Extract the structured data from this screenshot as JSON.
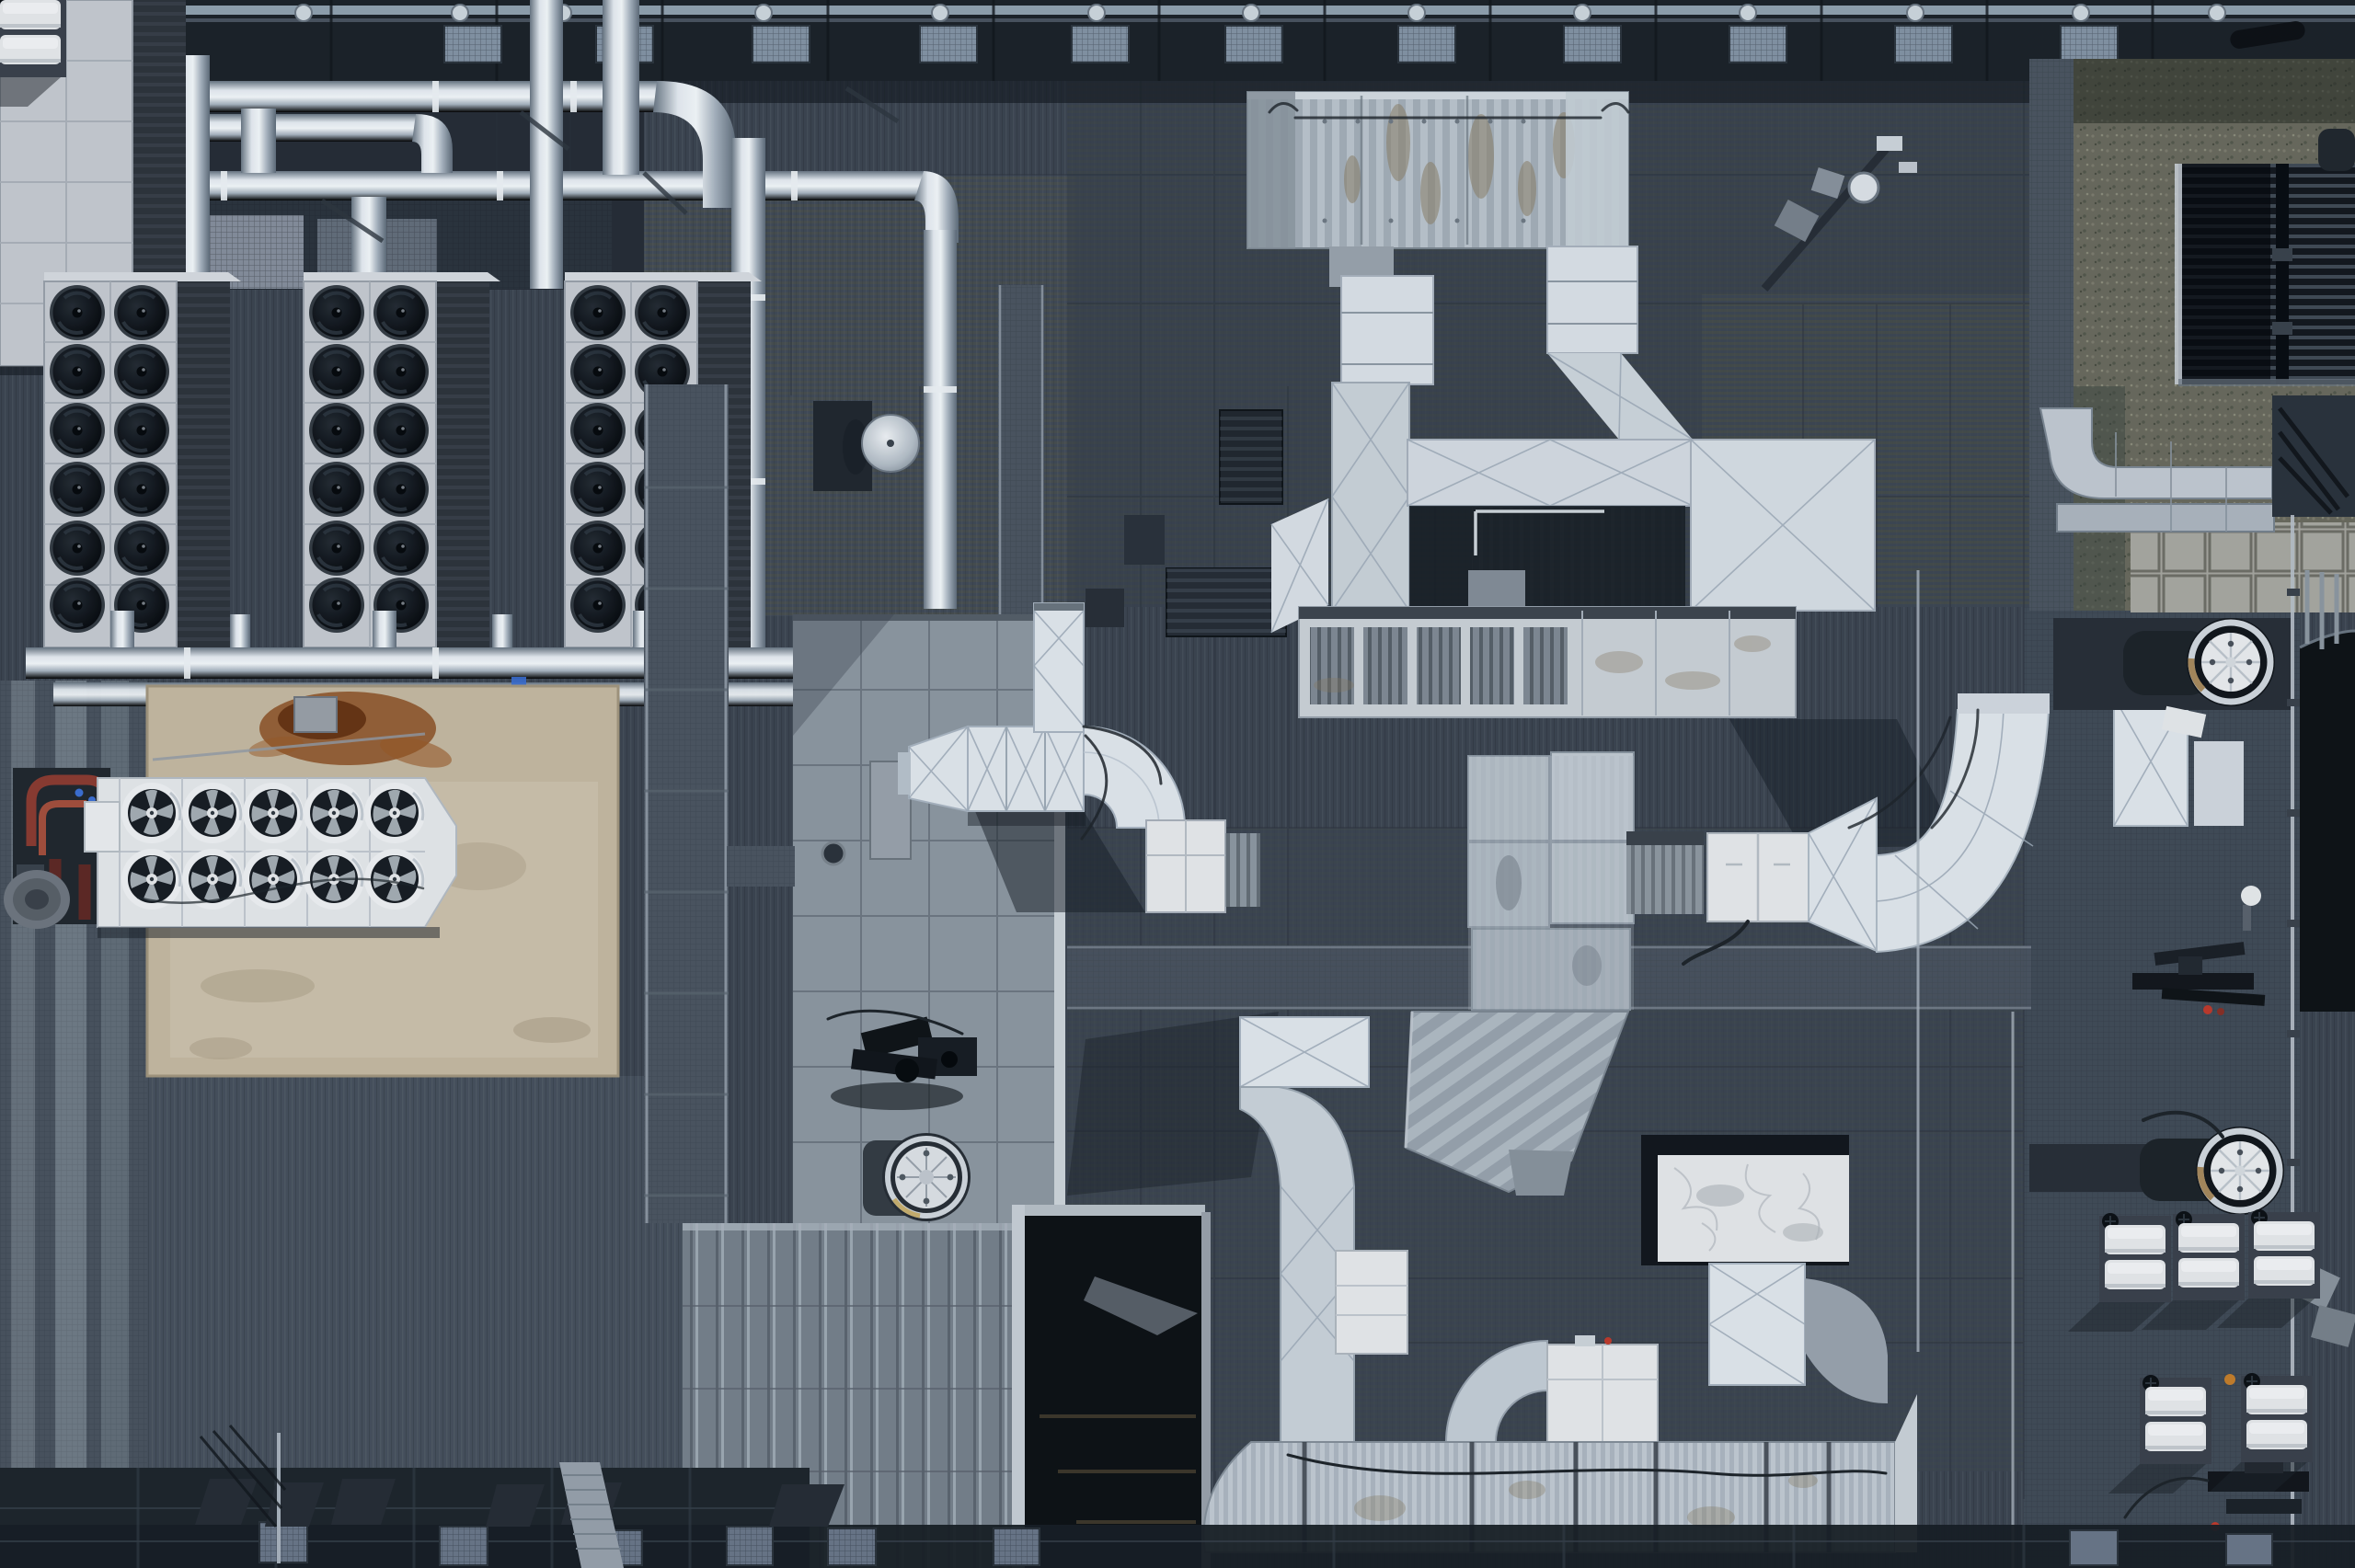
{
  "scene": {
    "type": "aerial-rooftop-photograph",
    "view": "top-down drone view, daytime, low sun casting shadows toward lower-left",
    "subject": "large commercial building rooftop crowded with HVAC equipment, silver refrigerant piping, white insulated ductwork, walkway gratings, gravel edge strip and maintenance machinery"
  },
  "colors": {
    "roof-base": "#3b4450",
    "roof-shadow": "#252c35",
    "strip-dark": "#1b2127",
    "mesh-light": "#8494a5",
    "frame-white": "#c8ccd2",
    "frame-light": "#dde0e4",
    "slat-dark": "#3e454e",
    "fan-dark": "#0e1217",
    "pad-beige": "#c7baa2",
    "rust": "#8a4a1c",
    "skid-dark": "#20262d",
    "pipe-red": "#8c3a30",
    "duct-white": "#e3e9ef",
    "duct-shade": "#b9c4d0",
    "duct-crease": "#9fabb8",
    "corr-gray": "#b2bcc5",
    "stain-brown": "#8a7c60",
    "panel-gray": "#8e98a2",
    "panel-line": "#67717b",
    "walk-gray": "#4b5560",
    "walk-light": "#7e8994",
    "opening-dark": "#0c1014",
    "gravel": "#6a6a5d",
    "paver": "#a7a7a0",
    "tower-dark": "#12171d",
    "tower-slat": "#4d5864",
    "chute-dark": "#0d1115",
    "ring-silver": "#d2d9df",
    "bronze": "#a8895c",
    "fan-face": "#edeff1",
    "box-white": "#e9ebee",
    "shadow-dark": "#161c23",
    "accent-green": "#3fae4a",
    "accent-blue": "#3b6fd4",
    "accent-red": "#c0392b",
    "cable": "#1d2329",
    "olive-moire": "#5e6049",
    "blue-mesh": "#47536a"
  },
  "objects": {
    "condenser_banks": {
      "count": 3,
      "fan_columns": 2,
      "fan_rows": 6,
      "fans_per_bank": 12,
      "finish": "white frame, black axial fans, dark louvered coil section"
    },
    "pad_chiller": {
      "fan_rows": 2,
      "fan_columns": 5,
      "fans_total": 10,
      "finish": "white casing on beige concrete pad"
    },
    "pipe_runs": {
      "finish": "polished stainless insulation jackets",
      "layout": "two horizontal headers feeding four vertical drops plus lower manifold"
    },
    "concrete_pad": {
      "stains": [
        "large rust-brown stain",
        "lighter water stains"
      ]
    },
    "pump_skid": {
      "pipe_color": "red-oxide / copper"
    },
    "dome_vent": {
      "count": 1
    },
    "turbine_vent": {
      "count": 1
    },
    "axial_roof_fans": {
      "count": 2,
      "finish": "dark housing, polished ring, white impeller face"
    },
    "top_duct_assembly": {
      "main_duct": "stained corrugated gray",
      "drop_boxes": 2,
      "bridge_duct": true
    },
    "long_ahu_box": {
      "louver_panels": 5
    },
    "white_duct_s_curves": {
      "count": 3
    },
    "cooling_tower": {
      "finish": "dark slatted louvres"
    },
    "gravel_strip": true,
    "paver_tiles": true,
    "mini_ac_boxes": {
      "clusters": 2,
      "boxes_total": 10
    },
    "bmu_maintenance_rigs": {
      "count": 2
    },
    "roof_opening": {
      "finish": "dark void with structural beams"
    },
    "antenna_mast": {
      "dishes": 3
    },
    "walkway_gratings": {
      "layout": "vertical and horizontal galvanized strips"
    }
  }
}
